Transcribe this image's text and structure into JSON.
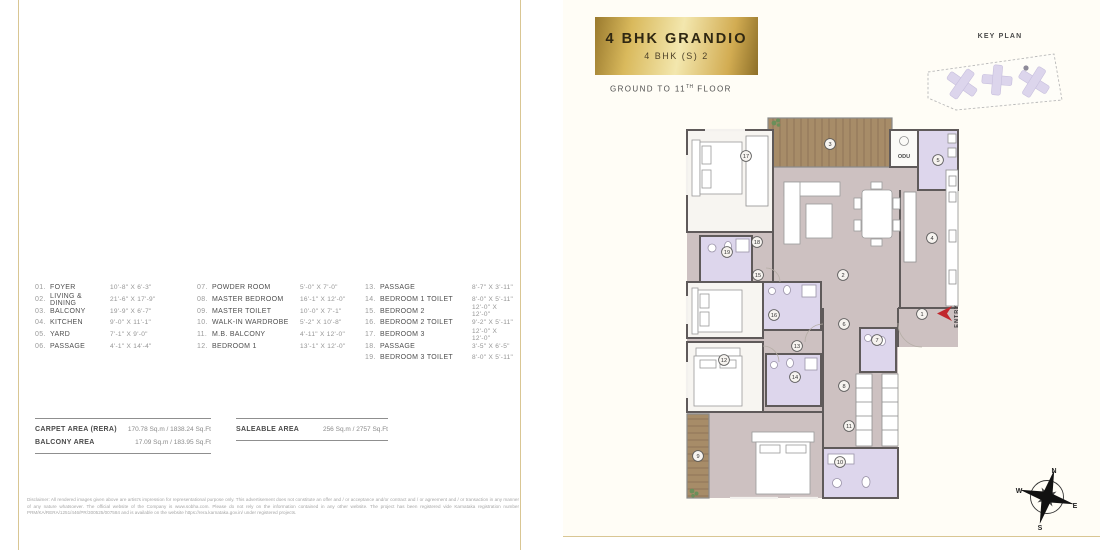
{
  "header": {
    "title": "4 BHK GRANDIO",
    "subtitle": "4 BHK (S) 2",
    "floor_range": {
      "prefix": "GROUND TO 11",
      "sup": "TH",
      "suffix": " FLOOR"
    }
  },
  "key_plan": {
    "label": "KEY PLAN"
  },
  "legend": {
    "columns": [
      {
        "items": [
          {
            "num": "01.",
            "name": "FOYER",
            "dim": "10'-8\" X 6'-3\""
          },
          {
            "num": "02.",
            "name": "LIVING & DINING",
            "dim": "21'-6\" X 17'-9\""
          },
          {
            "num": "03.",
            "name": "BALCONY",
            "dim": "19'-9\" X 6'-7\""
          },
          {
            "num": "04.",
            "name": "KITCHEN",
            "dim": "9'-0\" X 11'-1\""
          },
          {
            "num": "05.",
            "name": "YARD",
            "dim": "7'-1\" X 9'-0\""
          },
          {
            "num": "06.",
            "name": "PASSAGE",
            "dim": "4'-1\" X 14'-4\""
          }
        ]
      },
      {
        "items": [
          {
            "num": "07.",
            "name": "POWDER ROOM",
            "dim": "5'-0\" X 7'-0\""
          },
          {
            "num": "08.",
            "name": "MASTER BEDROOM",
            "dim": "16'-1\" X 12'-0\""
          },
          {
            "num": "09.",
            "name": "MASTER TOILET",
            "dim": "10'-0\" X 7'-1\""
          },
          {
            "num": "10.",
            "name": "WALK-IN WARDROBE",
            "dim": "5'-2\" X 10'-8\""
          },
          {
            "num": "11.",
            "name": "M.B. BALCONY",
            "dim": "4'-11\" X 12'-0\""
          },
          {
            "num": "12.",
            "name": "BEDROOM 1",
            "dim": "13'-1\" X 12'-0\""
          }
        ]
      },
      {
        "items": [
          {
            "num": "13.",
            "name": "PASSAGE",
            "dim": "8'-7\" X 3'-11\""
          },
          {
            "num": "14.",
            "name": "BEDROOM 1 TOILET",
            "dim": "8'-0\" X 5'-11\""
          },
          {
            "num": "15.",
            "name": "BEDROOM 2",
            "dim": "12'-0\" X 12'-0\""
          },
          {
            "num": "16.",
            "name": "BEDROOM 2 TOILET",
            "dim": "9'-2\" X 5'-11\""
          },
          {
            "num": "17.",
            "name": "BEDROOM 3",
            "dim": "12'-0\" X 12'-0\""
          },
          {
            "num": "18.",
            "name": "PASSAGE",
            "dim": "3'-5\" X 6'-5\""
          },
          {
            "num": "19.",
            "name": "BEDROOM 3 TOILET",
            "dim": "8'-0\" X 5'-11\""
          }
        ]
      }
    ]
  },
  "areas": {
    "carpet_label": "CARPET AREA (RERA)",
    "carpet_value": "170.78 Sq.m / 1838.24 Sq.Ft",
    "balcony_label": "BALCONY AREA",
    "balcony_value": "17.09 Sq.m / 183.95 Sq.Ft",
    "saleable_label": "SALEABLE AREA",
    "saleable_value": "256 Sq.m / 2757 Sq.Ft"
  },
  "disclaimer": "Disclaimer: All rendered images given above are artist's impression for representational purpose only. This advertisement does not constitute an offer and / or acceptance and/or contract and / or agreement and / or transaction in any manner of any nature whatsoever. The official website of the Company is www.sobha.com. Please do not rely on the information contained in any other website. The project has been registered vide Karnataka registration number PRM/KA/RERA/1251/446/PR/300525/007584 and is available on the website https://rera.karnataka.gov.in/ under registered projects.",
  "plan": {
    "odu_label": "ODU",
    "entry_label": "ENTRY",
    "markers": [
      {
        "n": "1",
        "x": 262,
        "y": 204
      },
      {
        "n": "2",
        "x": 183,
        "y": 165
      },
      {
        "n": "3",
        "x": 170,
        "y": 34
      },
      {
        "n": "4",
        "x": 272,
        "y": 128
      },
      {
        "n": "5",
        "x": 278,
        "y": 50
      },
      {
        "n": "6",
        "x": 184,
        "y": 214
      },
      {
        "n": "7",
        "x": 217,
        "y": 230
      },
      {
        "n": "8",
        "x": 184,
        "y": 276
      },
      {
        "n": "9",
        "x": 38,
        "y": 346
      },
      {
        "n": "10",
        "x": 180,
        "y": 352
      },
      {
        "n": "11",
        "x": 189,
        "y": 316
      },
      {
        "n": "12",
        "x": 64,
        "y": 250
      },
      {
        "n": "13",
        "x": 137,
        "y": 236
      },
      {
        "n": "14",
        "x": 135,
        "y": 267
      },
      {
        "n": "15",
        "x": 98,
        "y": 165
      },
      {
        "n": "16",
        "x": 114,
        "y": 205
      },
      {
        "n": "17",
        "x": 86,
        "y": 46
      },
      {
        "n": "18",
        "x": 97,
        "y": 132
      },
      {
        "n": "19",
        "x": 67,
        "y": 142
      }
    ]
  },
  "compass": {
    "n": "N",
    "e": "E",
    "s": "S",
    "w": "W"
  },
  "colors": {
    "accent_gold": "#d9c693",
    "floor": "#cdc1c1",
    "toilet": "#ddd6ec",
    "wood": "#a78c68",
    "entry_red": "#c1272d"
  }
}
